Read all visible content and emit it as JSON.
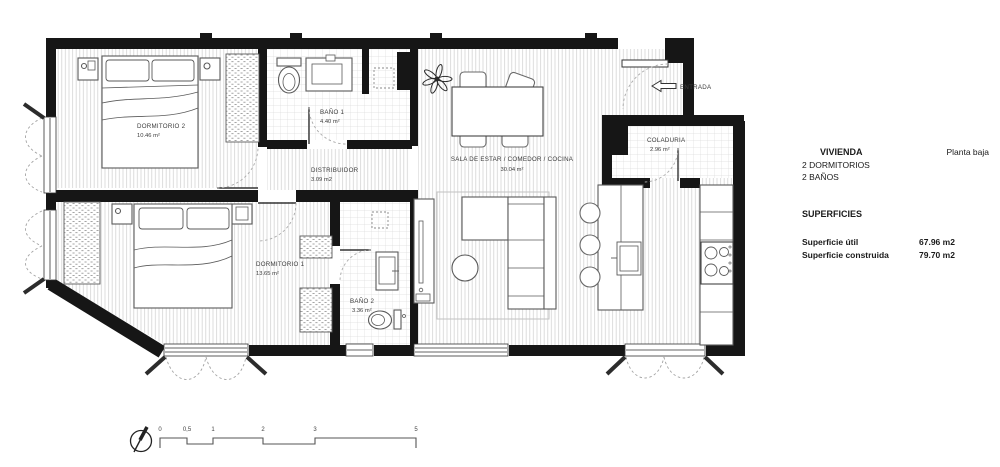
{
  "plan": {
    "rooms": {
      "dormitorio2": {
        "name": "DORMITORIO 2",
        "area": "10.46 m²"
      },
      "dormitorio1": {
        "name": "DORMITORIO 1",
        "area": "13.65 m²"
      },
      "bano1": {
        "name": "BAÑO 1",
        "area": "4.40 m²"
      },
      "bano2": {
        "name": "BAÑO 2",
        "area": "3.36 m²"
      },
      "distribuidor": {
        "name": "DISTRIBUIDOR",
        "area": "3.09 m2"
      },
      "sala": {
        "name": "SALA DE ESTAR / COMEDOR / COCINA",
        "area": "30.04 m²"
      },
      "coladuria": {
        "name": "COLADURIA",
        "area": "2.96 m²"
      }
    },
    "entrance_label": "ENTRADA",
    "scale_ticks": [
      "0",
      "0,5",
      "1",
      "2",
      "3",
      "5"
    ]
  },
  "info_panel": {
    "title": "VIVIENDA",
    "floor": "Planta baja",
    "features": [
      "2 DORMITORIOS",
      "2 BAÑOS"
    ],
    "surfaces_heading": "SUPERFICIES",
    "surfaces": [
      {
        "label": "Superficie útil",
        "value": "67.96 m2"
      },
      {
        "label": "Superficie construida",
        "value": "79.70 m2"
      }
    ]
  },
  "colors": {
    "wall": "#161616",
    "floor_hatch": "#d4d4d4",
    "tile_line": "#dddddd",
    "furniture_line": "#5a5a5a",
    "text": "#3c3c3c"
  }
}
